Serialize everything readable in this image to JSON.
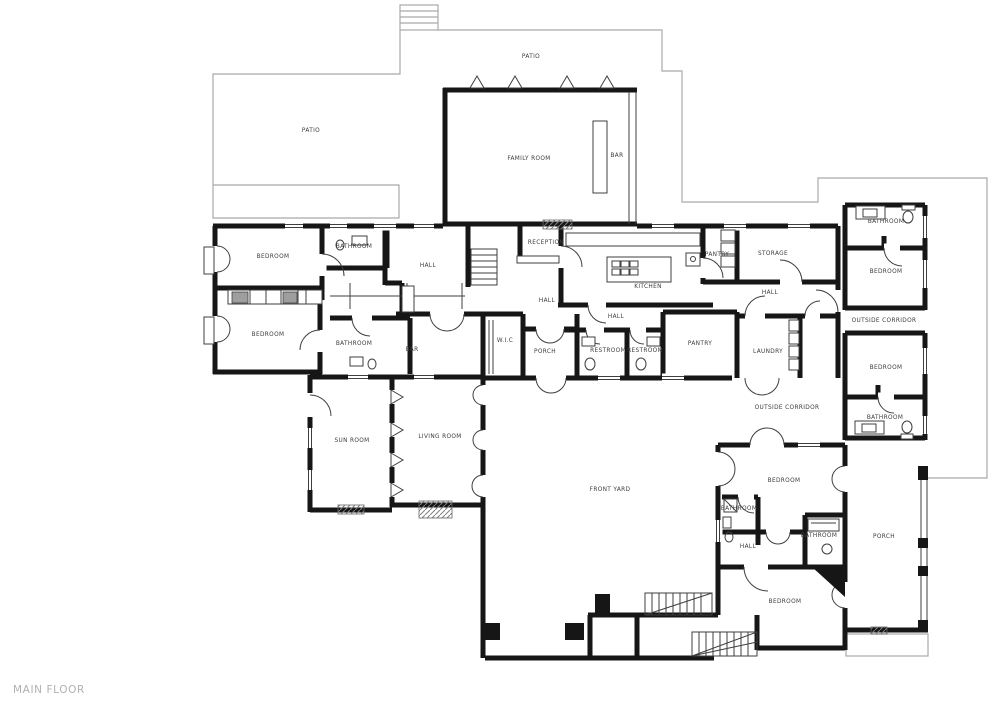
{
  "title": {
    "label": "MAIN FLOOR"
  },
  "palette": {
    "wall": "#161616",
    "thin_line": "#3f3f3f",
    "property_line": "#a9a9a9",
    "label_text": "#3d3d3d",
    "title_text": "#b1b1b1",
    "closet_fill": "#9e9e9e",
    "background": "#ffffff"
  },
  "rooms": [
    {
      "id": "patio-top",
      "label": "PATIO"
    },
    {
      "id": "patio-left",
      "label": "PATIO"
    },
    {
      "id": "family-room",
      "label": "FAMILY ROOM"
    },
    {
      "id": "bar-top",
      "label": "BAR"
    },
    {
      "id": "bedroom-nw",
      "label": "BEDROOM"
    },
    {
      "id": "bathroom-nw",
      "label": "BATHROOM"
    },
    {
      "id": "hall-nw",
      "label": "HALL"
    },
    {
      "id": "reception",
      "label": "RECEPTION"
    },
    {
      "id": "kitchen",
      "label": "KITCHEN"
    },
    {
      "id": "pantry-north",
      "label": "PANTRY"
    },
    {
      "id": "storage",
      "label": "STORAGE"
    },
    {
      "id": "hall-center",
      "label": "HALL"
    },
    {
      "id": "hall-mid",
      "label": "HALL"
    },
    {
      "id": "hall-ne",
      "label": "HALL"
    },
    {
      "id": "bathroom-ne",
      "label": "BATHROOM"
    },
    {
      "id": "bedroom-ne",
      "label": "BEDROOM"
    },
    {
      "id": "outside-corridor-e",
      "label": "OUTSIDE CORRIDOR"
    },
    {
      "id": "bedroom-w",
      "label": "BEDROOM"
    },
    {
      "id": "bathroom-w",
      "label": "BATHROOM"
    },
    {
      "id": "bar-west",
      "label": "BAR"
    },
    {
      "id": "wic",
      "label": "W.I.C"
    },
    {
      "id": "porch-center",
      "label": "PORCH"
    },
    {
      "id": "restroom-1",
      "label": "RESTROOM"
    },
    {
      "id": "restroom-2",
      "label": "RESTROOM"
    },
    {
      "id": "pantry-south",
      "label": "PANTRY"
    },
    {
      "id": "laundry",
      "label": "LAUNDRY"
    },
    {
      "id": "bedroom-e",
      "label": "BEDROOM"
    },
    {
      "id": "bathroom-e",
      "label": "BATHROOM"
    },
    {
      "id": "outside-corridor-s",
      "label": "OUTSIDE CORRIDOR"
    },
    {
      "id": "sun-room",
      "label": "SUN ROOM"
    },
    {
      "id": "living-room",
      "label": "LIVING ROOM"
    },
    {
      "id": "front-yard",
      "label": "FRONT YARD"
    },
    {
      "id": "bedroom-se-1",
      "label": "BEDROOM"
    },
    {
      "id": "bathroom-se-1",
      "label": "BATHROOM"
    },
    {
      "id": "bathroom-se-2",
      "label": "BATHROOM"
    },
    {
      "id": "hall-se",
      "label": "HALL"
    },
    {
      "id": "porch-east",
      "label": "PORCH"
    },
    {
      "id": "bedroom-se-2",
      "label": "BEDROOM"
    }
  ]
}
